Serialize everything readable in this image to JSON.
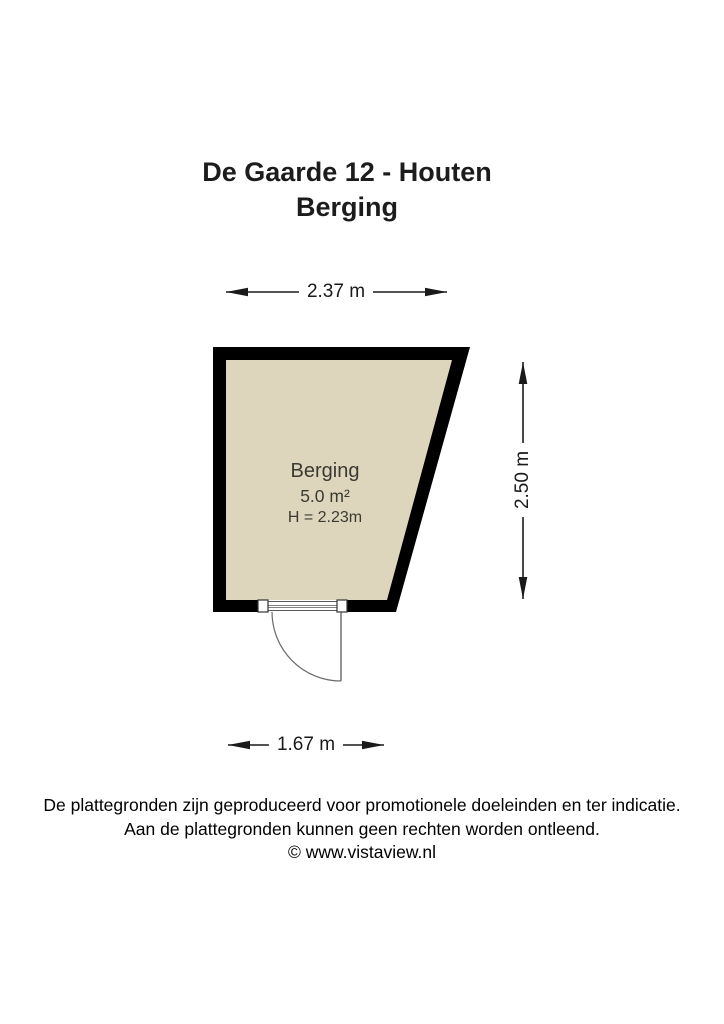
{
  "title": {
    "line1": "De Gaarde 12 - Houten",
    "line2": "Berging"
  },
  "room": {
    "name": "Berging",
    "area": "5.0 m²",
    "ceiling_height": "H = 2.23m"
  },
  "dimensions": {
    "width_top": "2.37 m",
    "height_right": "2.50 m",
    "width_door_bottom": "1.67 m"
  },
  "footer": {
    "line1": "De plattegronden zijn geproduceerd voor promotionele doeleinden en ter indicatie.",
    "line2": "Aan de plattegronden kunnen geen rechten worden ontleend.",
    "line3": "© www.vistaview.nl"
  },
  "colors": {
    "wall": "#000000",
    "room_fill": "#ded6bc",
    "room_text": "#3a3a33",
    "dimension_line": "#1a1a1a",
    "door_line": "#5a5a5a",
    "background": "#ffffff"
  }
}
